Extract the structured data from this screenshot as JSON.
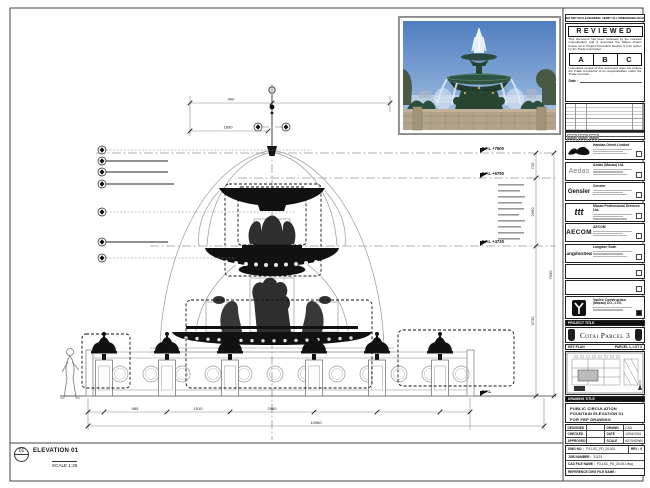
{
  "drawing": {
    "elevation_bubble": "01",
    "elevation_label": "ELEVATION 01",
    "scale_label": "SCALE 1:25",
    "levels": {
      "l1": "F.F.L +7500",
      "l2": "F.F.L +6790",
      "l3": "F.F.L +4730",
      "l4": "F.F.L"
    },
    "dims": {
      "top1": "400",
      "top2": "1890",
      "right1": "710",
      "right2": "2060",
      "right3": "4730",
      "right4": "7500",
      "b1": "985",
      "b2": "1510",
      "b3": "2980",
      "total": "10960"
    }
  },
  "stamp": {
    "header": "DO NOT SCALE DRAWING. VERIFY ALL DIMENSIONS ON SITE.",
    "title": "REVIEWED",
    "para1": "This document has been reviewed by the relevant Consultant(s) and is accorded the Status shown below, as in Project Procedure Section 5.4 for action by the Trade Contractor.",
    "statuses": [
      "A",
      "B",
      "C"
    ],
    "para2": "Consultant review of this document does not relieve the Trade Contractor of its responsibilities under the Trade Contract.",
    "date_label": "Date :"
  },
  "consultants": [
    {
      "name": "Handan Orient Limited"
    },
    {
      "name": "Aedas (Macau) Ltd.",
      "logo": "Aedas"
    },
    {
      "name": "Gensler",
      "logo": "Gensler"
    },
    {
      "name": "Macau Professional Services Ltd.",
      "logo": "ttt"
    },
    {
      "name": "AECOM",
      "logo": "AECOM"
    },
    {
      "name": "Langdon Seah",
      "logo": "LangdonSeah"
    }
  ],
  "contractor": {
    "name1": "Yaulee Construction",
    "name2": "(Macau) CO., LTD."
  },
  "project": {
    "band": "PROJECT TITLE",
    "title": "Cotai Parcel 3"
  },
  "key_plan": {
    "band": "KEY PLAN",
    "right": "PARCEL 1, LOT 3"
  },
  "drawing_title": {
    "band": "DRAWING TITLE",
    "line1": "PUBLIC CIRCULATION",
    "line2": "FOUNTAIN ELEVATION 01",
    "line3": "FOR FBP DRAWING"
  },
  "title_table": {
    "designed_label": "DESIGNED",
    "designed": "-",
    "checked_label": "CHECKED",
    "checked": "-",
    "approved_label": "APPROVED",
    "approved": "-",
    "drawn_label": "DRAWN",
    "drawn": "CAD",
    "date_label": "DATE",
    "date": "12/04/2016",
    "scale_label": "SCALE",
    "scale": "AS SHOWN"
  },
  "refs": {
    "dwg_label": "DWG NO. :",
    "dwg": "P3-LSC_PD_20-001",
    "rev_label": "REV :",
    "rev": "0",
    "job_label": "JOB NUMBER :",
    "job": "31123",
    "cad_label": "CAD FILE NAME :",
    "cad": "P3-LSC_PD_20-001.dwg",
    "ref_label": "REFERENCE DWG FILE NAME :"
  }
}
